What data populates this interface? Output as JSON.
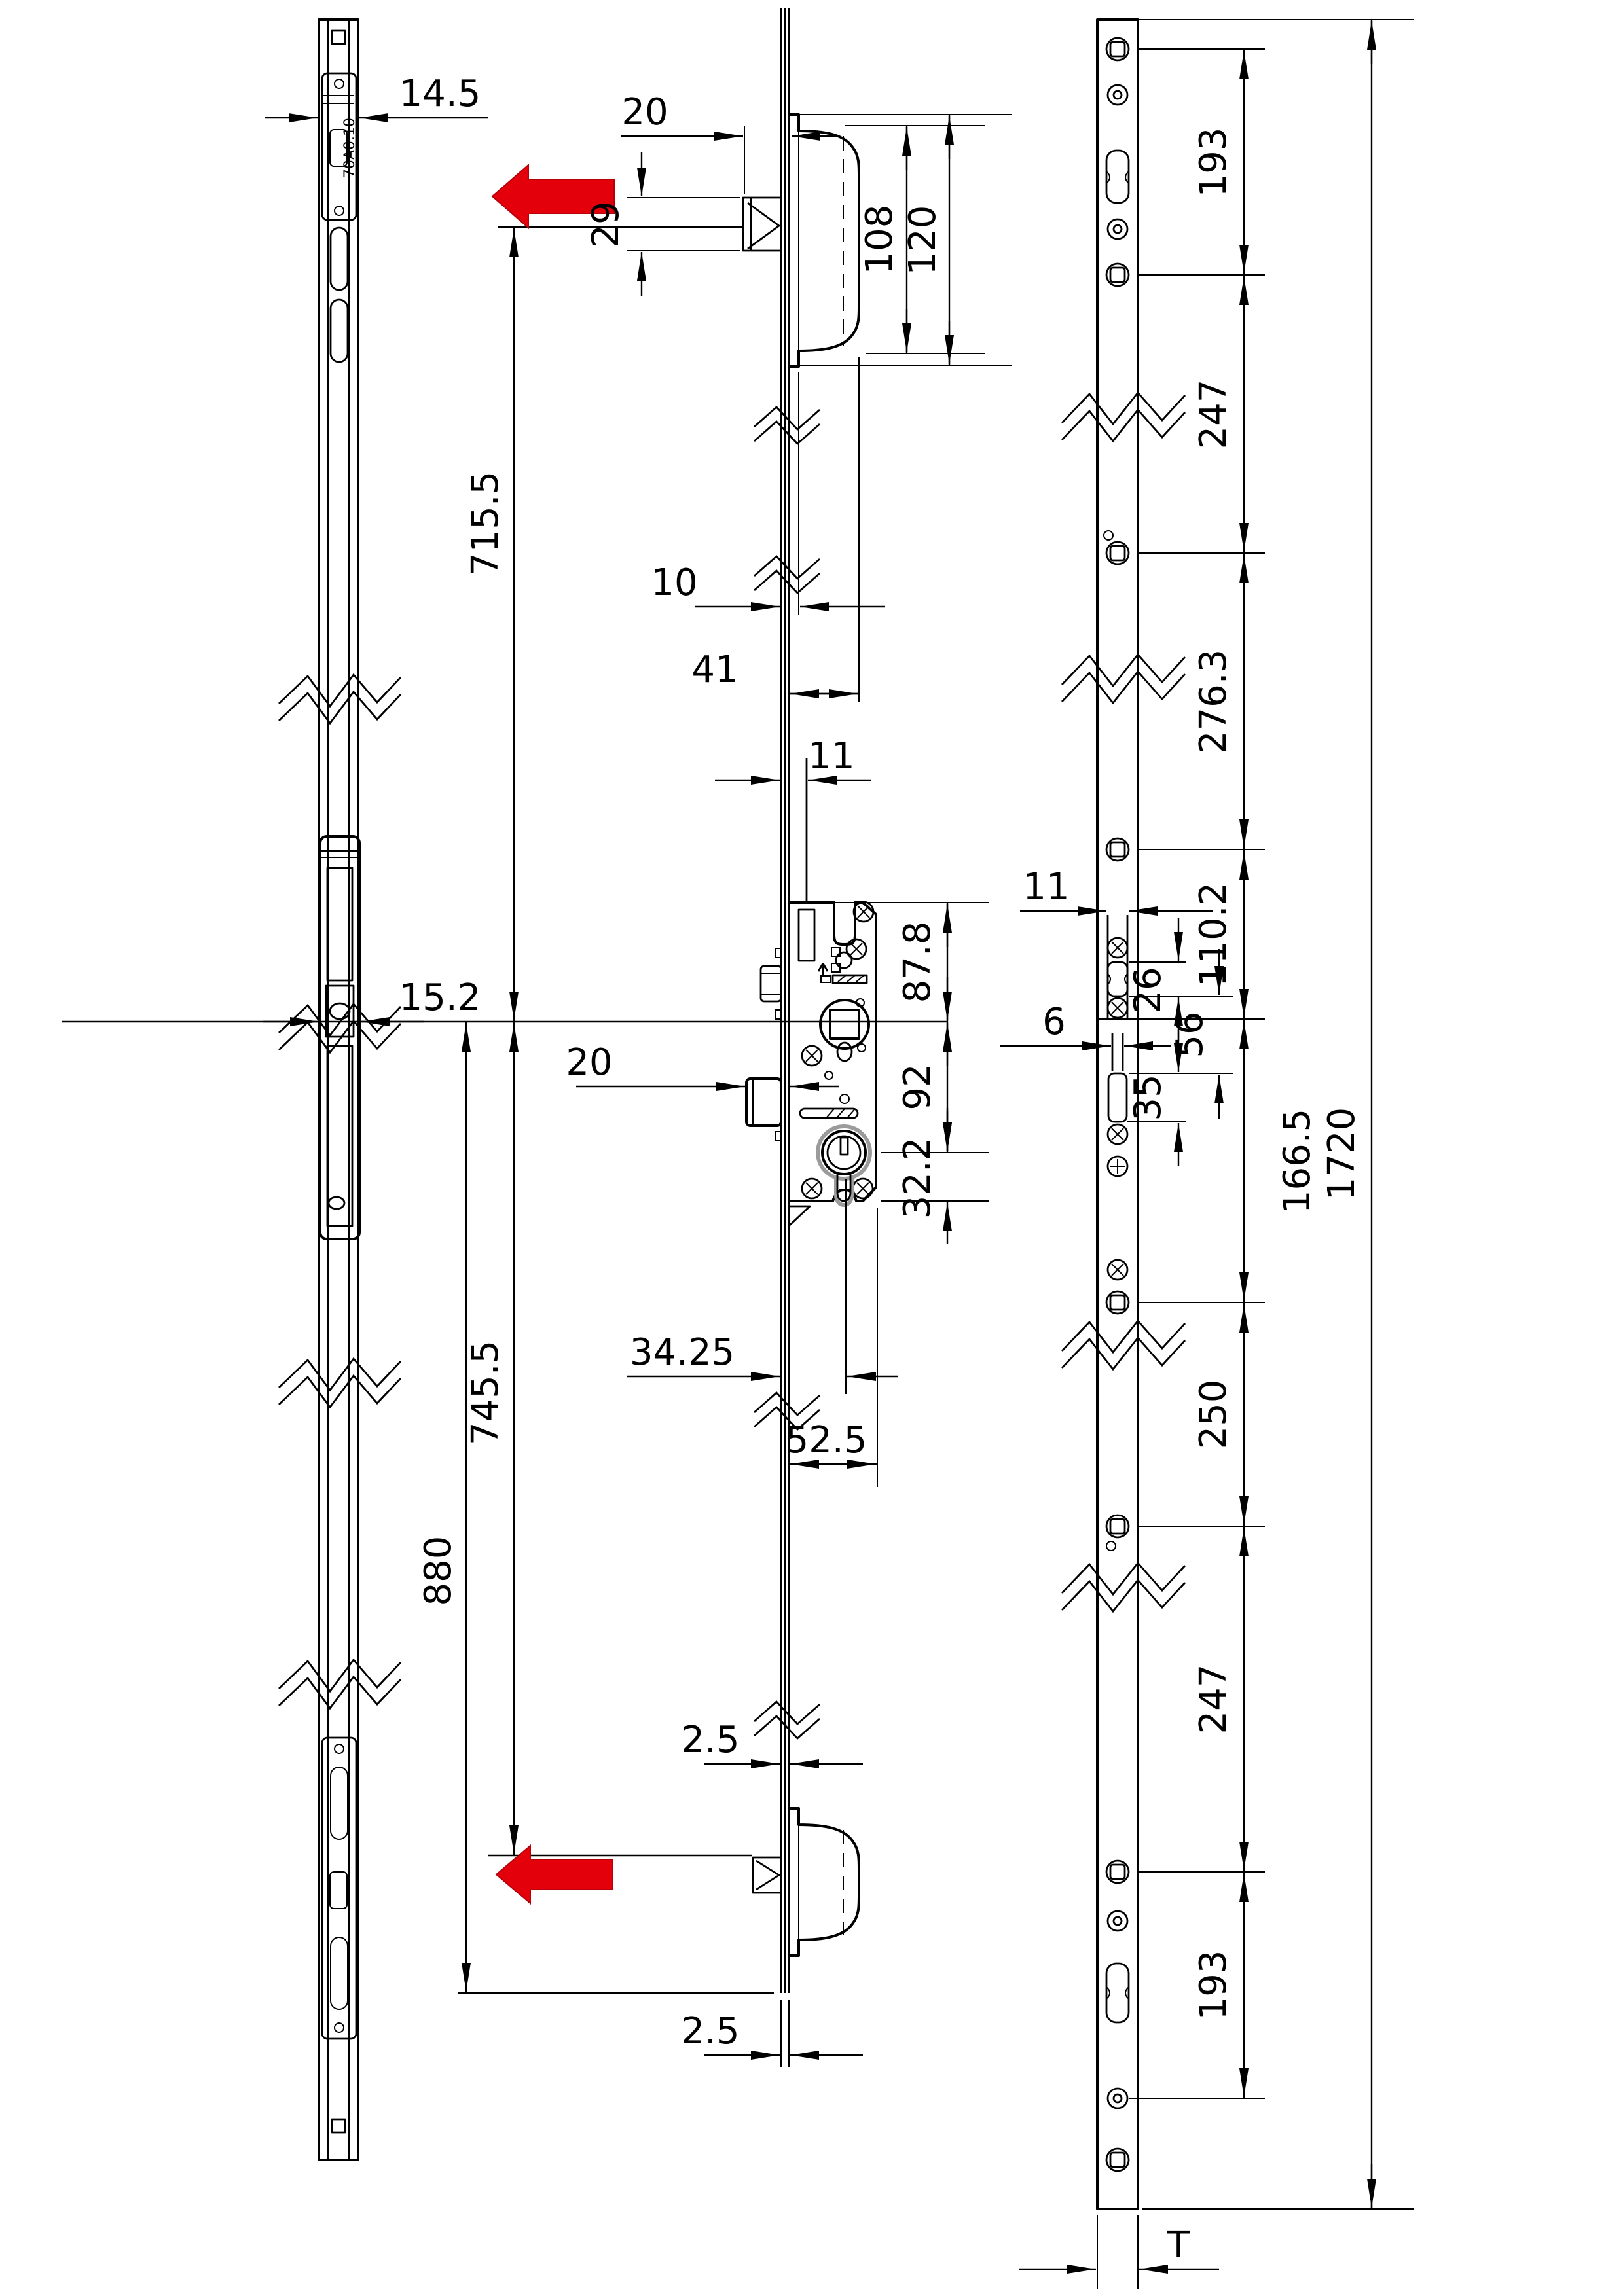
{
  "colors": {
    "line": "#000000",
    "red": "#e3000b",
    "gray": "#9b9b9b"
  },
  "left_module_label": "70A0.10",
  "dims": {
    "d14_5": "14.5",
    "d20_top": "20",
    "d29": "29",
    "d108": "108",
    "d120": "120",
    "d10": "10",
    "d41": "41",
    "d715_5": "715.5",
    "d11_mid": "11",
    "d87_8": "87.8",
    "d92": "92",
    "d32_2": "32.2",
    "d15_2": "15.2",
    "d20_bolt": "20",
    "d34_25": "34.25",
    "d745_5": "745.5",
    "d52_5": "52.5",
    "d880": "880",
    "d2_5_a": "2.5",
    "d2_5_b": "2.5",
    "d193_top": "193",
    "d247_top": "247",
    "d276_3": "276.3",
    "d11_right": "11",
    "d110_2": "110.2",
    "d26": "26",
    "d56": "56",
    "d6": "6",
    "d35": "35",
    "d166_5": "166.5",
    "d250": "250",
    "d247_bot": "247",
    "d193_bot": "193",
    "d1720": "1720",
    "dT": "T"
  }
}
